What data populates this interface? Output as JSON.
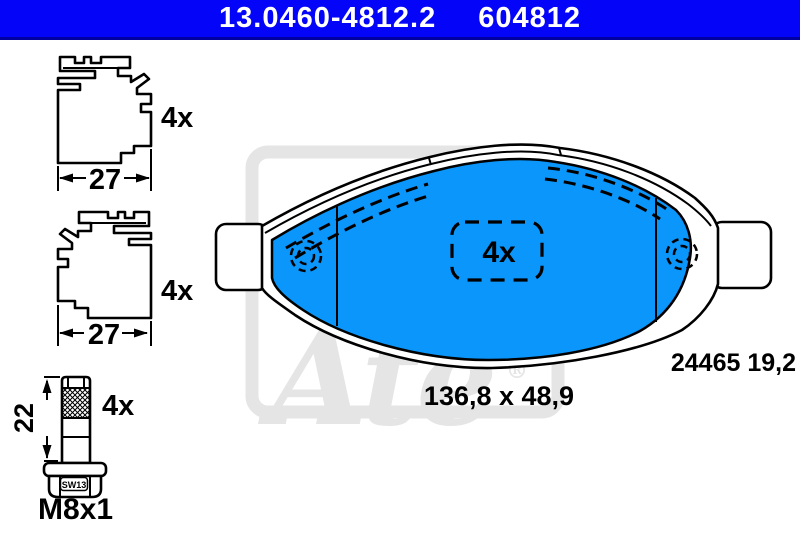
{
  "header": {
    "part_number": "13.0460-4812.2",
    "ref_number": "604812"
  },
  "accessories": {
    "clip_top": {
      "qty": "4x",
      "width_dim": "27"
    },
    "clip_bottom": {
      "qty": "4x",
      "width_dim": "27"
    },
    "bolt": {
      "qty": "4x",
      "length_dim": "22",
      "thread": "M8x1",
      "wrench_size": "SW13"
    }
  },
  "pad": {
    "qty": "4x",
    "wva_thickness": "24465 19,2",
    "dimensions": "136,8 x 48,9"
  },
  "watermark": {
    "brand": "Ate",
    "reg": "®"
  },
  "colors": {
    "header_bg": "#0405F8",
    "header_border": "#0000A0",
    "pad_blue": "#0A96FA",
    "watermark": "#E5E5E5"
  }
}
